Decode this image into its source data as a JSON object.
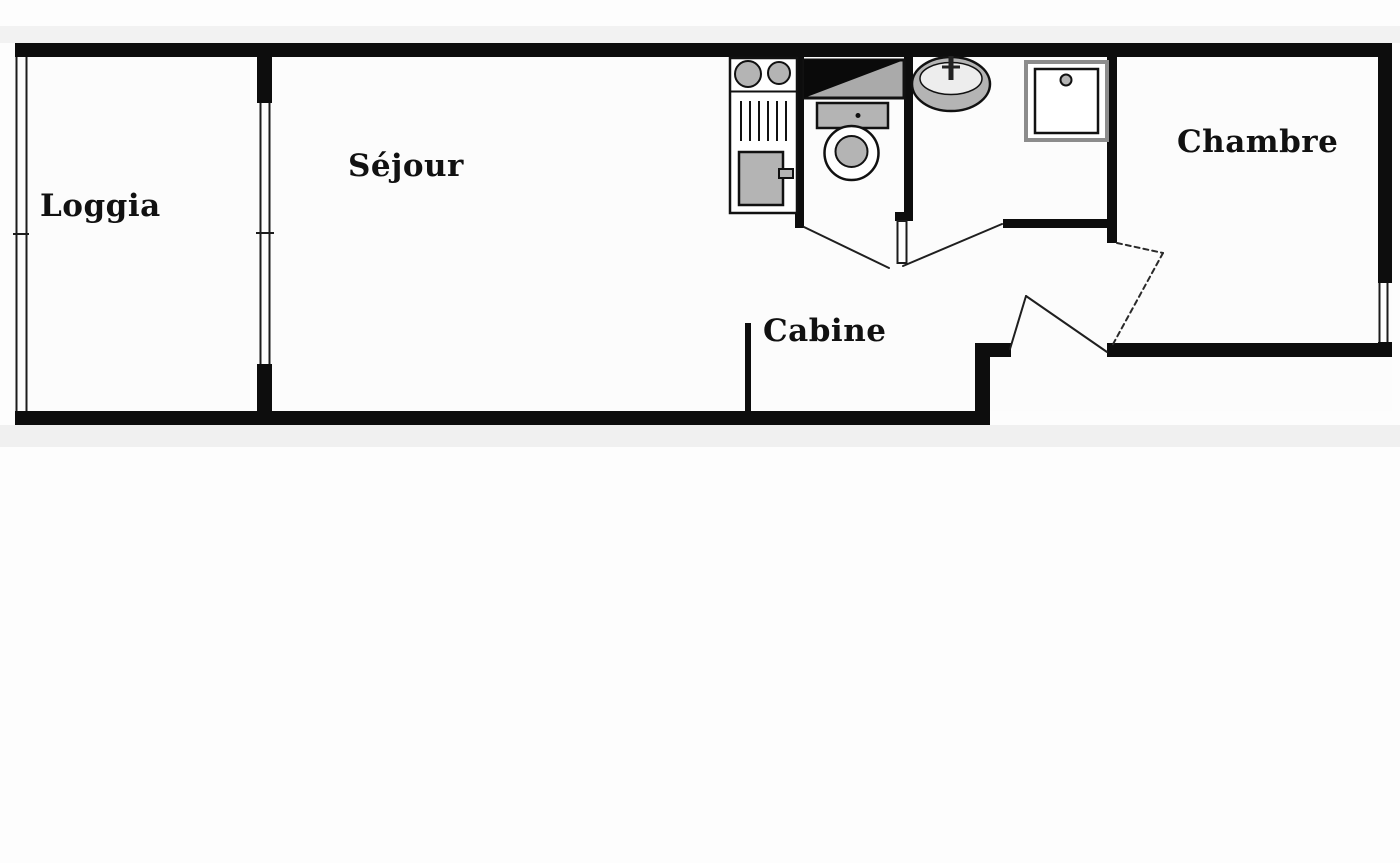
{
  "plan": {
    "type": "apartment-floor-plan",
    "rooms": [
      {
        "id": "loggia",
        "label": "Loggia"
      },
      {
        "id": "sejour",
        "label": "Séjour"
      },
      {
        "id": "cabine",
        "label": "Cabine"
      },
      {
        "id": "chambre",
        "label": "Chambre"
      }
    ],
    "fixtures": [
      "stove-burners-icon",
      "drainer-icon",
      "kitchen-sink-icon",
      "water-heater-icon",
      "toilet-icon",
      "washbasin-icon",
      "shower-tray-icon"
    ],
    "colors": {
      "wall": "#0d0d0d",
      "fixture_gray": "#b4b4b4",
      "appliance_black": "#0a0a0a",
      "background": "#fdfdfd",
      "band_gray": "#f1f1f1",
      "label": "#111111"
    }
  }
}
